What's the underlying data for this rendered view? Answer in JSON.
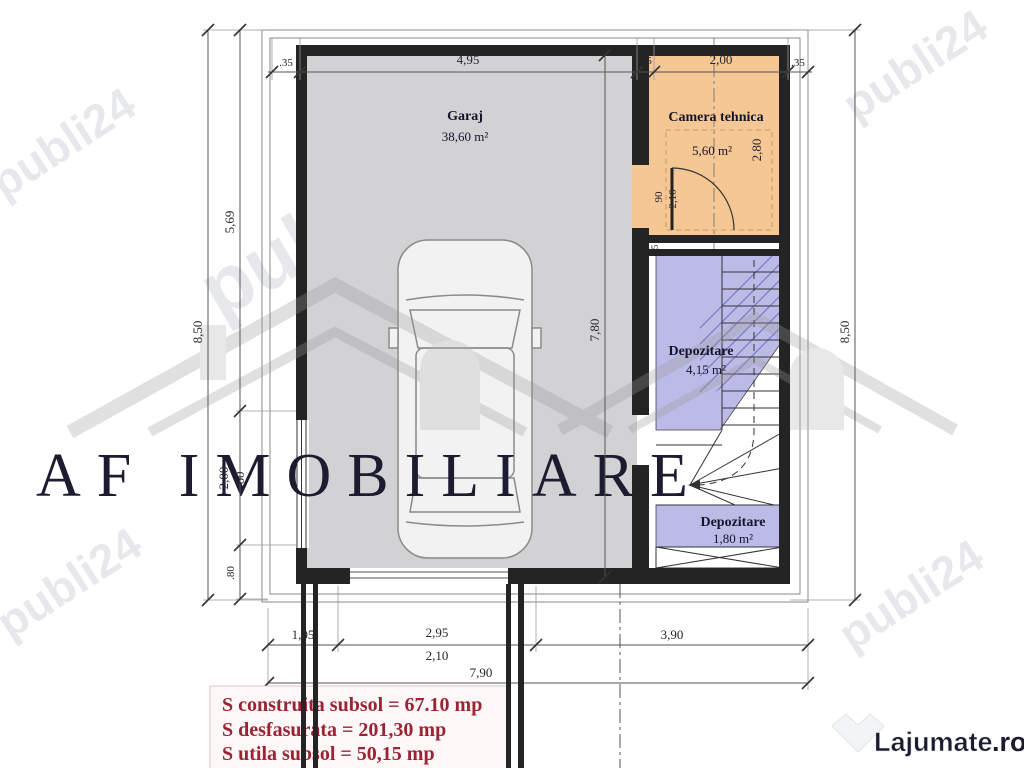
{
  "rooms": {
    "garage": {
      "label": "Garaj",
      "area": "38,60 m²"
    },
    "technical": {
      "label": "Camera tehnica",
      "area": "5,60 m²"
    },
    "storage1": {
      "label": "Depozitare",
      "area": "4,15 m²"
    },
    "storage2": {
      "label": "Depozitare",
      "area": "1,80 m²"
    }
  },
  "dims": {
    "top": [
      ".35",
      "4,95",
      ".25",
      "2,00",
      ".35"
    ],
    "left_total": "8,50",
    "left_segments": [
      "5,69",
      "2,00",
      "60",
      ".80"
    ],
    "right_total": "8,50",
    "garage_interior": "7,80",
    "technical_interior": "2,80",
    "door_width": "90",
    "door_height": "2,10",
    "wall_small": "5",
    "bottom": [
      "1,05",
      "2,95",
      "3,90"
    ],
    "bottom_sub": "2,10",
    "bottom_total": "7,90"
  },
  "summary": {
    "line1": "S construita subsol = 67.10 mp",
    "line2": "S desfasurata = 201,30 mp",
    "line3": "S utila subsol = 50,15 mp"
  },
  "watermarks": {
    "portal": "publi24",
    "agency": "AF IMOBILIARE",
    "footer_site": "Lajumate",
    "footer_tld": ".ro"
  },
  "colors": {
    "garage_fill": "#d2d2d4",
    "technical_fill": "#f5c795",
    "storage_fill": "#bcbbe7",
    "wall": "#242424",
    "dimension_line": "#555555",
    "label_text": "#14142c",
    "summary_text": "#9c2333",
    "footer_tld": "#8fd6cd"
  }
}
